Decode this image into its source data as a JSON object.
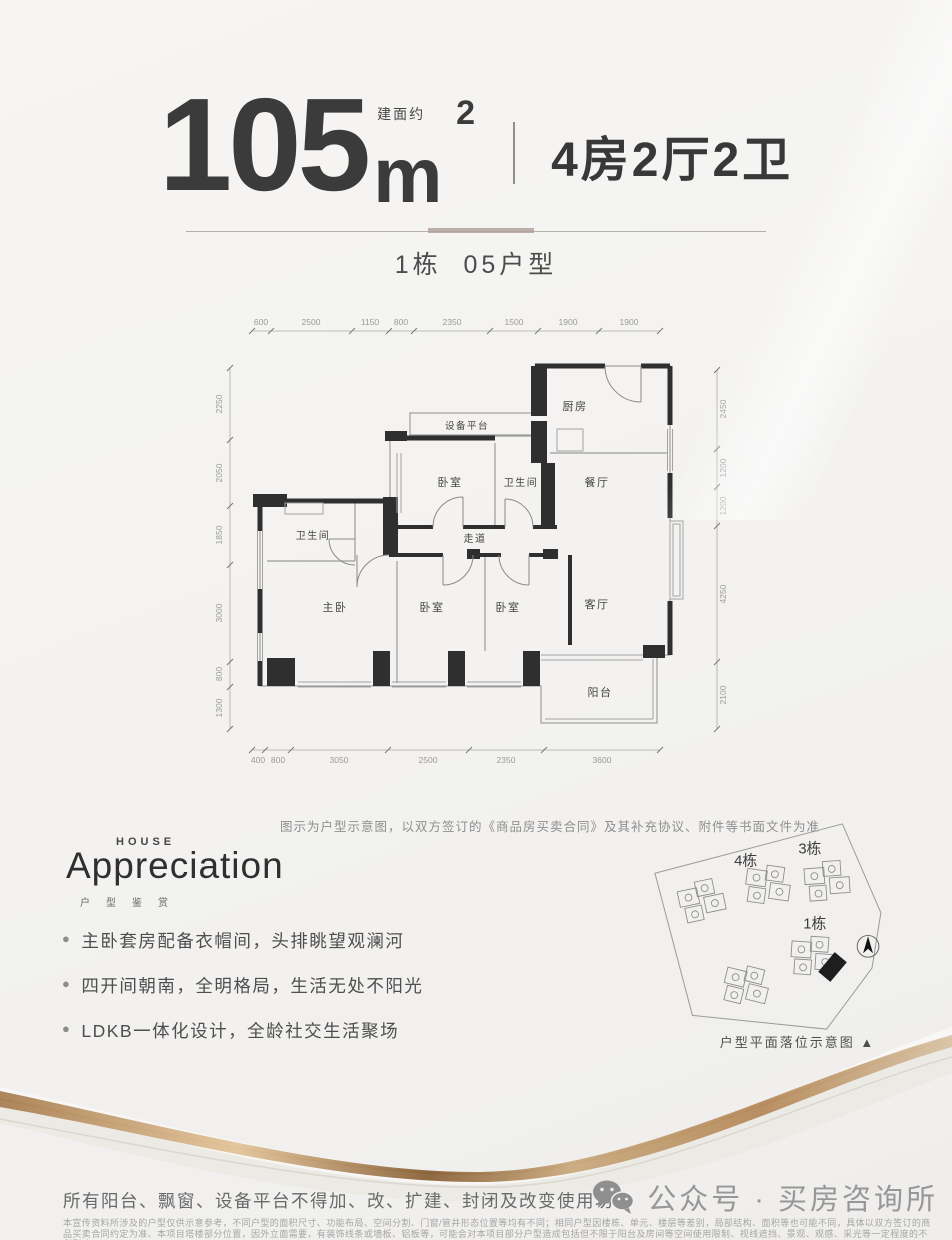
{
  "header": {
    "area_prefix": "建面约",
    "area_value": "105",
    "area_unit": "m",
    "area_sup": "2",
    "layout": "4房2厅2卫",
    "subtitle": "1栋  05户型"
  },
  "plan": {
    "rooms": {
      "kitchen": "厨房",
      "equipment": "设备平台",
      "bedroom_top": "卧室",
      "bath_top": "卫生间",
      "dining": "餐厅",
      "bath_left": "卫生间",
      "corridor": "走道",
      "master": "主卧",
      "bedroom_b1": "卧室",
      "bedroom_b2": "卧室",
      "living": "客厅",
      "balcony": "阳台"
    },
    "dims_top": [
      "600",
      "2500",
      "1150",
      "800",
      "2350",
      "1500",
      "1900",
      "1900"
    ],
    "dims_bottom": [
      "400",
      "800",
      "3050",
      "2500",
      "2350",
      "3600"
    ],
    "dims_left": [
      "2250",
      "2050",
      "1850",
      "3000",
      "800",
      "1300"
    ],
    "dims_right": [
      "2450",
      "1200",
      "1200",
      "4250",
      "2100"
    ],
    "note": "图示为户型示意图，以双方签订的《商品房买卖合同》及其补充协议、附件等书面文件为准"
  },
  "brand": {
    "house": "HOUSE",
    "name": "Appreciation",
    "sub": "户型鉴赏"
  },
  "features": [
    "主卧套房配备衣帽间，头排眺望观澜河",
    "四开间朝南，全明格局，生活无处不阳光",
    "LDKB一体化设计，全龄社交生活聚场"
  ],
  "siteplan": {
    "b4": "4栋",
    "b3": "3栋",
    "b1": "1栋",
    "caption": "户型平面落位示意图 ▲"
  },
  "footer": {
    "warning": "所有阳台、飘窗、设备平台不得加、改、扩建、封闭及改变使用功能",
    "fine1": "本宣传资料所涉及的户型仅供示意参考，不同户型的面积尺寸、功能布局、空间分割、门窗/管井形态位置等均有不同；相同户型因楼栋、单元、楼层等差别，局部结构、面积等也可能不同，具体以双方签订的商",
    "fine2": "品买卖合同约定为准、本项目塔楼部分位置，因外立面需要，有装饰线条或墙板、铝板等，可能会对本项目部分户型造成包括但不限于阳台及房间等空间使用限制、视线遮挡、景观、观感、采光等一定程度的不",
    "fine3": "利影响",
    "wechat": "公众号 · 买房咨询所"
  },
  "colors": {
    "wall": "#2f2f2f",
    "accent_gold": "#b08d5f",
    "text_dark": "#3a3a3a",
    "text_gray": "#8f8f8f"
  }
}
